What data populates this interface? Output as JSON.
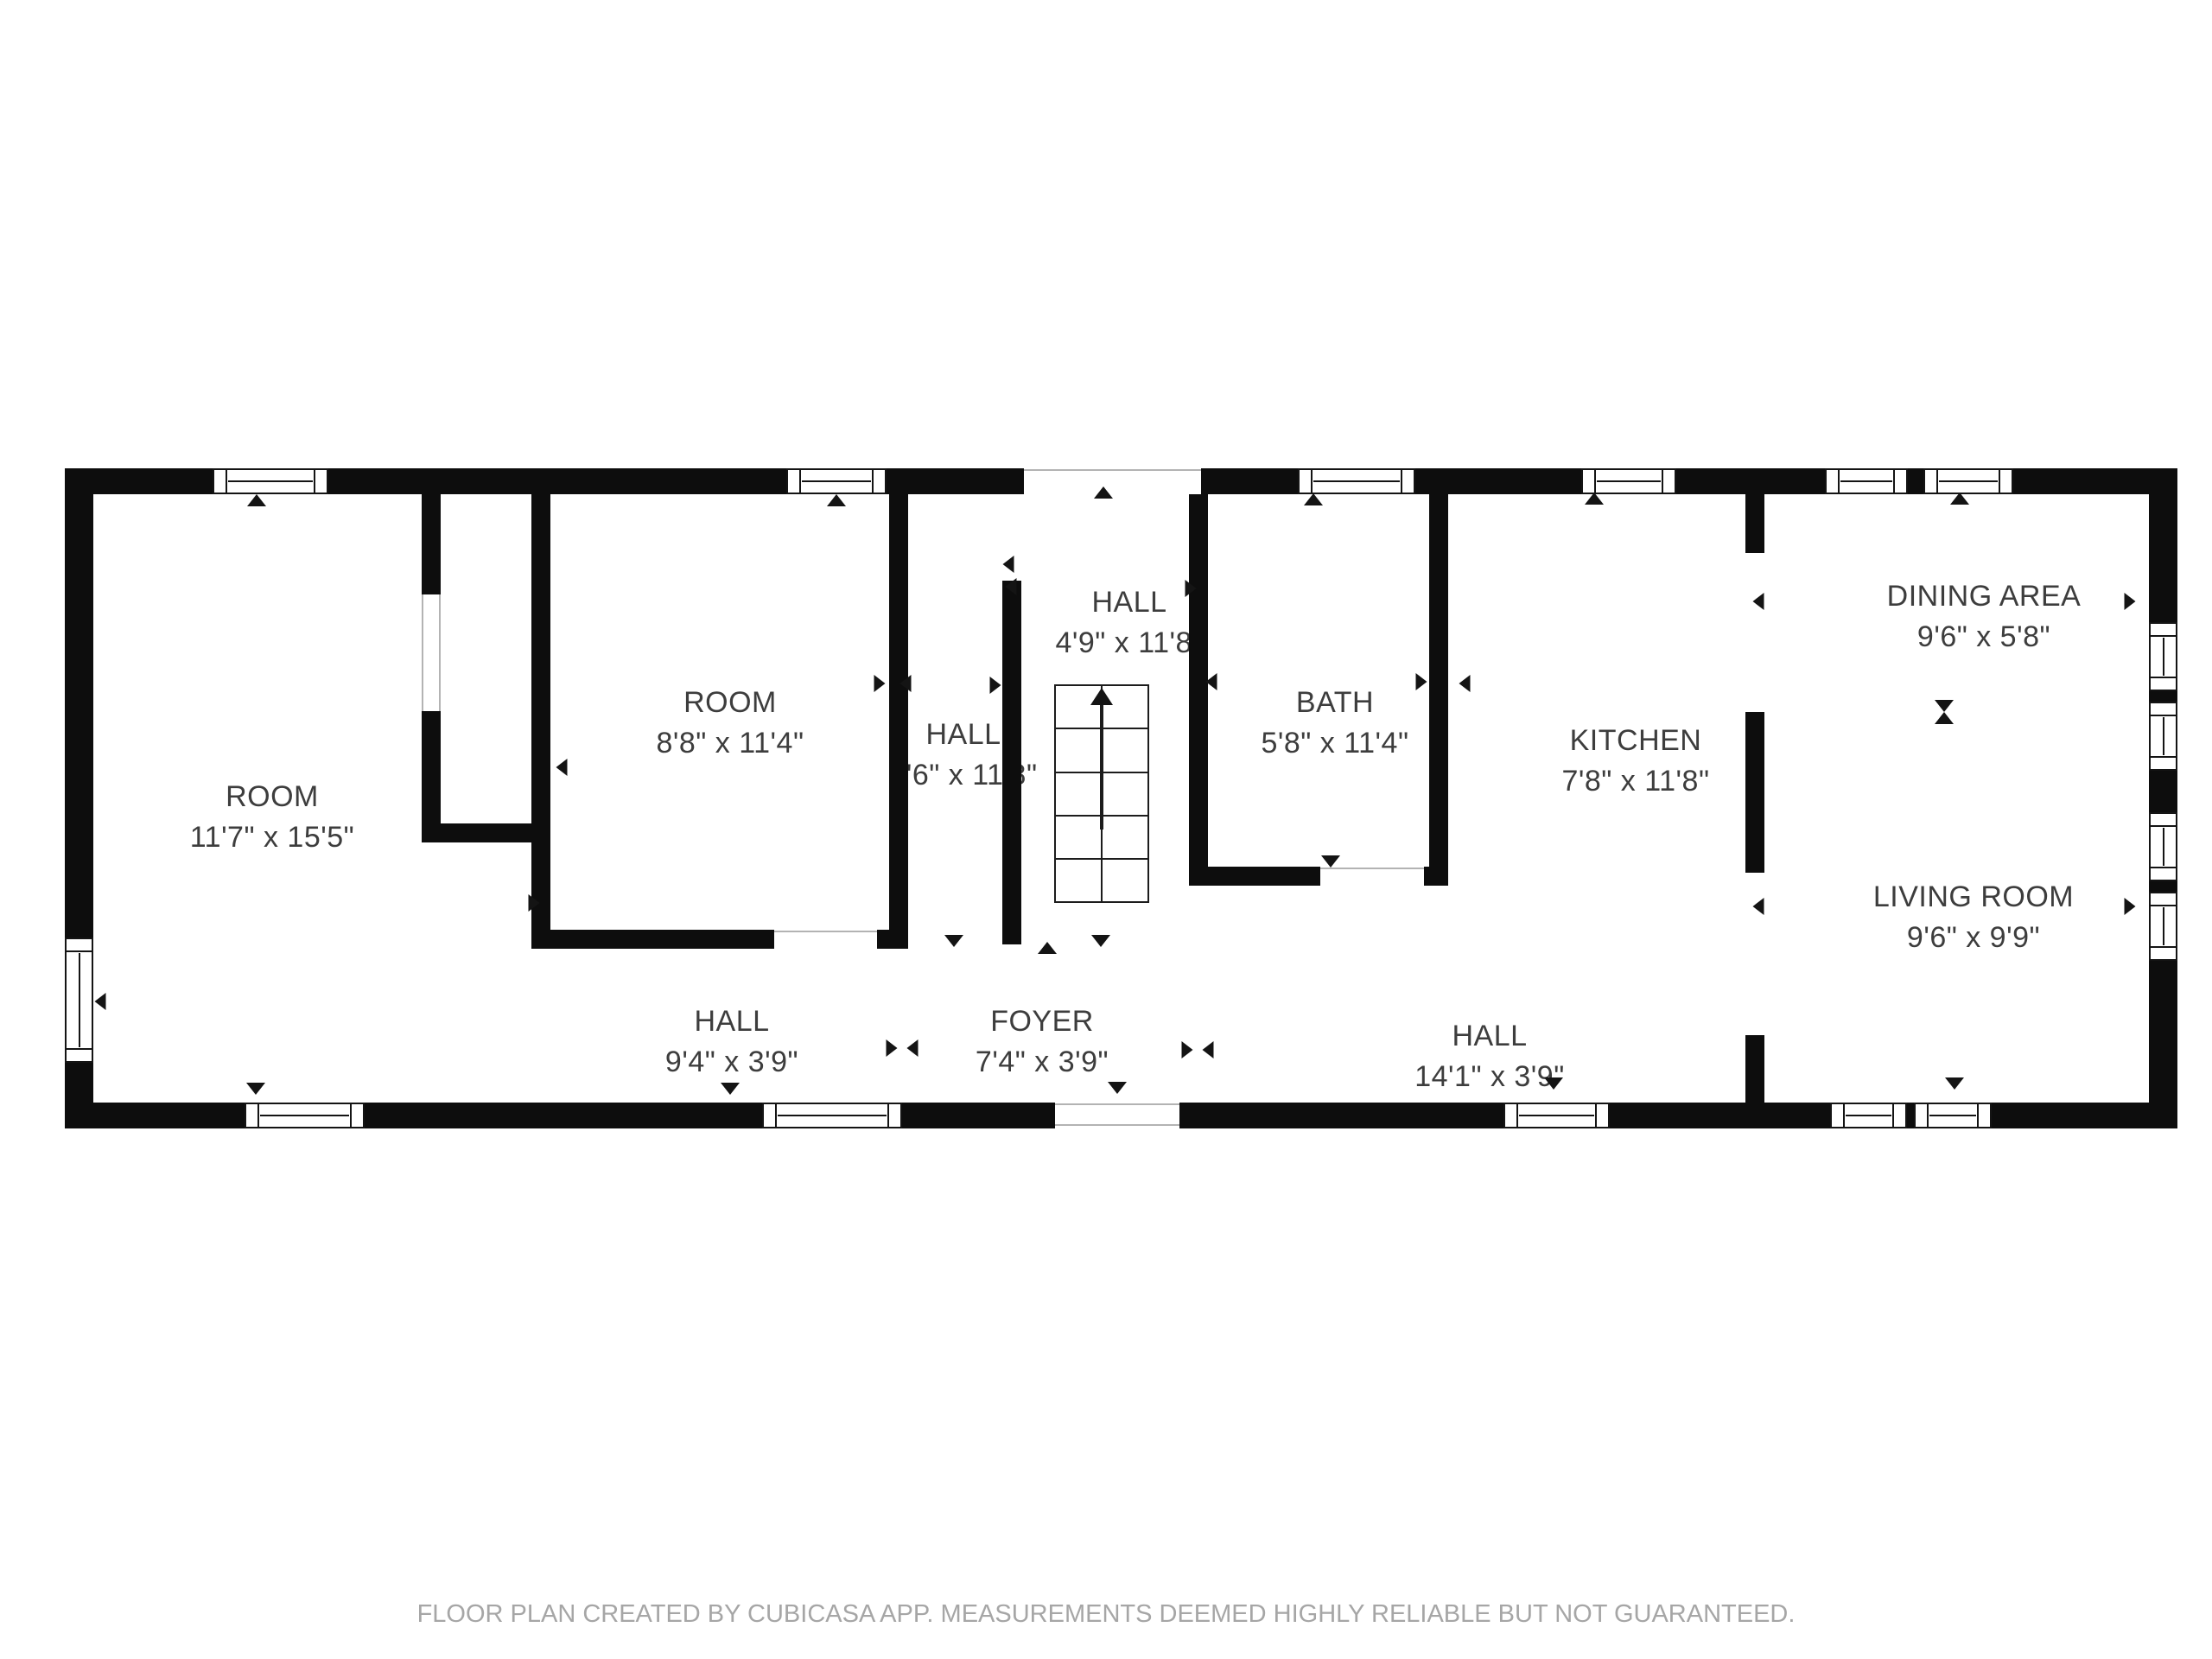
{
  "floor_plan": {
    "rooms": [
      {
        "name": "ROOM",
        "dims": "11'7\" x 15'5\""
      },
      {
        "name": "ROOM",
        "dims": "8'8\" x 11'4\""
      },
      {
        "name": "HALL",
        "dims": "2'6\" x 11'8\""
      },
      {
        "name": "HALL",
        "dims": "4'9\" x 11'8\""
      },
      {
        "name": "BATH",
        "dims": "5'8\" x 11'4\""
      },
      {
        "name": "KITCHEN",
        "dims": "7'8\" x 11'8\""
      },
      {
        "name": "DINING AREA",
        "dims": "9'6\" x 5'8\""
      },
      {
        "name": "LIVING ROOM",
        "dims": "9'6\" x 9'9\""
      },
      {
        "name": "HALL",
        "dims": "9'4\" x 3'9\""
      },
      {
        "name": "FOYER",
        "dims": "7'4\" x 3'9\""
      },
      {
        "name": "HALL",
        "dims": "14'1\" x 3'9\""
      }
    ],
    "footer": "FLOOR PLAN CREATED BY CUBICASA APP. MEASUREMENTS DEEMED HIGHLY RELIABLE BUT NOT GUARANTEED."
  }
}
